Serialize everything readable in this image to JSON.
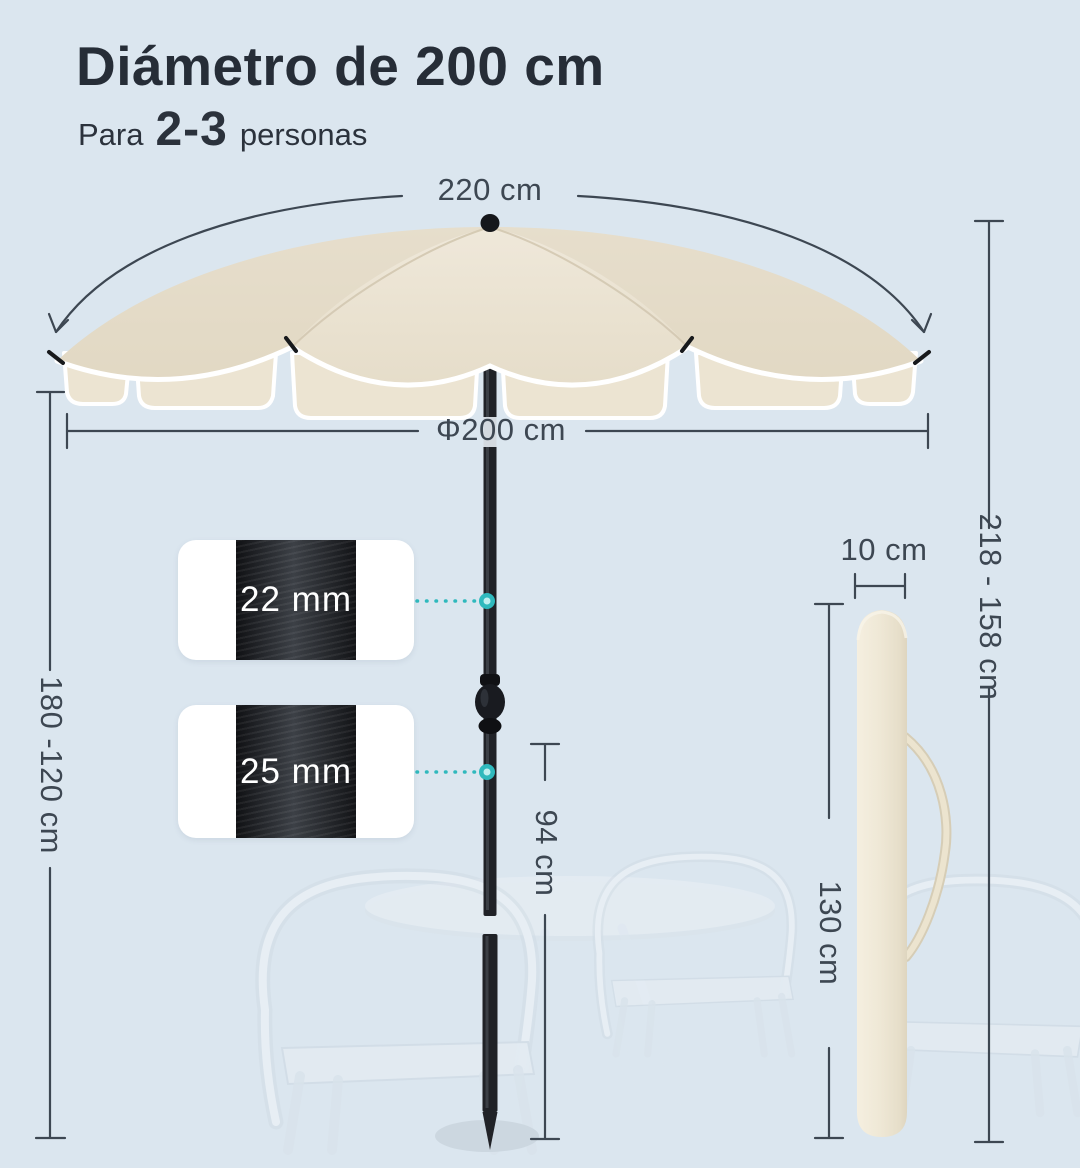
{
  "header": {
    "title": "Diámetro de 200 cm",
    "subtitle": {
      "prefix": "Para",
      "highlight": "2-3",
      "suffix": "personas"
    }
  },
  "dimensions": {
    "canopy_arc_width": "220 cm",
    "canopy_diameter": "Φ200 cm",
    "pole_height_range": "180 -120 cm",
    "lower_segment_height": "94 cm",
    "total_height_range": "218 - 158 cm",
    "bag_diameter": "10 cm",
    "bag_length": "130 cm"
  },
  "callouts": {
    "upper_pole_thickness": "22 mm",
    "lower_pole_thickness": "25 mm"
  },
  "colors": {
    "background": "#dbe6ef",
    "canopy": "#e9e1d0",
    "canopy_trim": "#ffffff",
    "valance": "#ece4d2",
    "pole": "#202227",
    "accent_teal": "#2fb9bd",
    "dimension_line": "#3d4752",
    "text_dark": "#262d37",
    "bag": "#efe8d6"
  }
}
